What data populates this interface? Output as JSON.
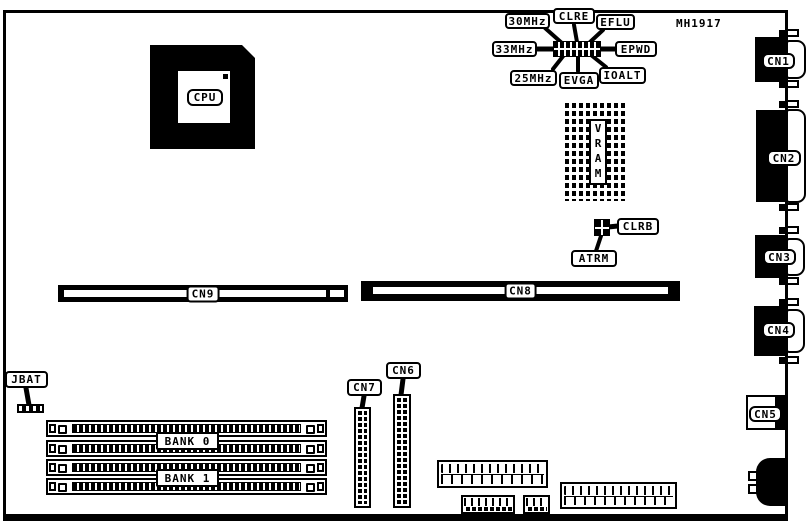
{
  "meta": {
    "colors": {
      "ink": "#000000",
      "paper": "#ffffff"
    }
  },
  "board": {
    "part_number": "MH1917",
    "cpu_label": "CPU",
    "vram_label": "VRAM",
    "jumper_labels": {
      "mhz30": "30MHz",
      "clre": "CLRE",
      "eflu": "EFLU",
      "mhz33": "33MHz",
      "epwd": "EPWD",
      "mhz25": "25MHz",
      "evga": "EVGA",
      "ioalt": "IOALT",
      "clrb": "CLRB",
      "atrm": "ATRM",
      "jbat": "JBAT"
    },
    "slot_labels": {
      "cn9": "CN9",
      "cn8": "CN8"
    },
    "header_labels": {
      "cn7": "CN7",
      "cn6": "CN6"
    },
    "memory_labels": {
      "bank0": "BANK 0",
      "bank1": "BANK 1"
    },
    "rear_labels": {
      "cn1": "CN1",
      "cn2": "CN2",
      "cn3": "CN3",
      "cn4": "CN4",
      "cn5": "CN5"
    }
  }
}
